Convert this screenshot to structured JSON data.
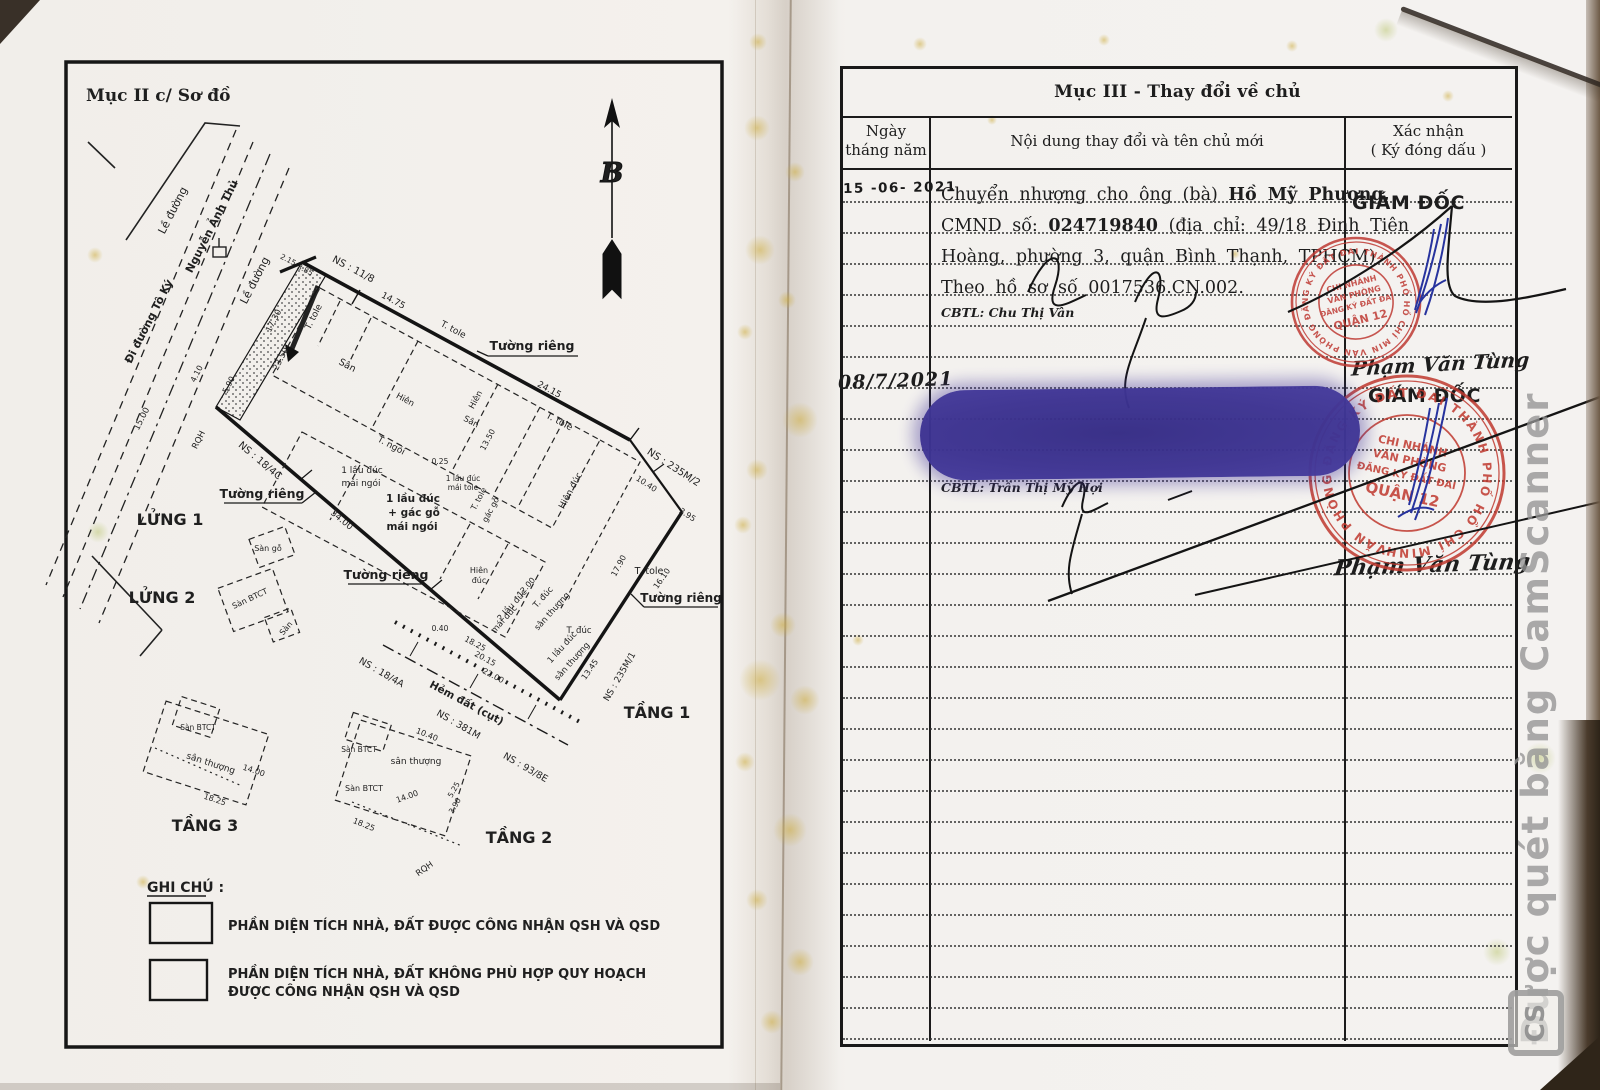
{
  "watermark": {
    "text": "Được quét bằng CamScanner",
    "logo": "CS"
  },
  "left_page": {
    "title": "Mục II c/ Sơ đồ",
    "compass": "B",
    "legend": {
      "title": "GHI CHÚ :",
      "item1": "PHẦN DIỆN TÍCH NHÀ, ĐẤT ĐƯỢC CÔNG NHẬN QSH VÀ QSD",
      "item2a": "PHẦN DIỆN TÍCH NHÀ, ĐẤT KHÔNG PHÙ HỢP QUY HOẠCH",
      "item2b": "ĐƯỢC CÔNG NHẬN QSH VÀ QSD"
    },
    "plan_labels": [
      "Lề đường",
      "Nguyễn Ảnh Thủ",
      "Đi đường Tô Ký",
      "Lề đường",
      "NS : 11/8",
      "T. tole",
      "17.30",
      "23.50",
      "2.15",
      "3.85",
      "Tường riêng",
      "14.75",
      "24.15",
      "Sân",
      "T. tole",
      "Hiên",
      "T. ngói",
      "Hiên",
      "Sân",
      "13.50",
      "T. tole",
      "1 lầu đúc",
      "mái ngói",
      "1 lầu đúc",
      "+ gác gỗ",
      "mái ngói",
      "1 lầu đúc",
      "mái tole",
      "T. tole",
      "gác gỗ",
      "0.25",
      "Hiên đúc",
      "NS : 18/4C",
      "Tường riêng",
      "34.00",
      "LỬNG 1",
      "Sàn gỗ",
      "LỬNG 2",
      "Sàn BTCT",
      "Sàn",
      "Tường riêng",
      "Hiên",
      "đúc",
      "2 lầu đúc",
      "mái đúc",
      "T. đúc",
      "sân thượng",
      "12.00",
      "1 lầu đúc",
      "sân thượng",
      "18.25",
      "20.15",
      "22.00",
      "0.40",
      "Hẻm đất (cụt)",
      "NS : 381M",
      "NS : 18/4A",
      "NS : 93/8E",
      "T. đúc",
      "17.90",
      "T. tole",
      "NS : 235M/2",
      "10.40",
      "3.95",
      "16.10",
      "Tường riêng",
      "13.45",
      "NS : 235M/1",
      "TẦNG 1",
      "Sàn BTCT",
      "sân thượng",
      "14.00",
      "18.25",
      "TẦNG 3",
      "Sàn BTCT",
      "sân thượng",
      "Sàn BTCT",
      "14.00",
      "18.25",
      "10.40",
      "5.25",
      "3.90",
      "TẦNG 2",
      "RQH",
      "RQH",
      "15.00",
      "4.10",
      "5.90"
    ]
  },
  "right_page": {
    "title": "Mục III - Thay đổi về chủ",
    "col_date": "Ngày tháng năm",
    "col_content": "Nội dung thay đổi và tên chủ mới",
    "col_confirm_1": "Xác nhận",
    "col_confirm_2": "( Ký đóng dấu )",
    "row1": {
      "date": "15 -06- 2021",
      "l1": "Chuyển nhượng cho ông (bà)",
      "name": "Hồ Mỹ Phương,",
      "l2a": "CMND số:",
      "num": "024719840",
      "l2b": "(địa chỉ: 49/18 Đinh Tiên",
      "l3": "Hoàng, phường 3, quận Bình Thạnh, TPHCM)",
      "l4": "Theo hồ sơ số  0017536.CN.002.",
      "cbtl": "CBTL: Chu Thị Vân",
      "confirm": "GIÁM ĐỐC"
    },
    "row2": {
      "date": "08/7/2021",
      "cbtl": "CBTL: Trần Thị Mỹ Hợi",
      "signer": "Phạm Văn Tùng",
      "confirm": "GIÁM ĐỐC",
      "signer2": "Phạm Văn Tùng"
    },
    "stamp": {
      "ring": "VĂN PHÒNG ĐĂNG KÝ ĐẤT ĐAI THÀNH PHỐ HỒ CHÍ MINH",
      "l1": "CHI NHÁNH",
      "l2": "VĂN PHÒNG",
      "l3": "ĐĂNG KÝ ĐẤT ĐAI",
      "l4": "QUẬN 12"
    }
  }
}
